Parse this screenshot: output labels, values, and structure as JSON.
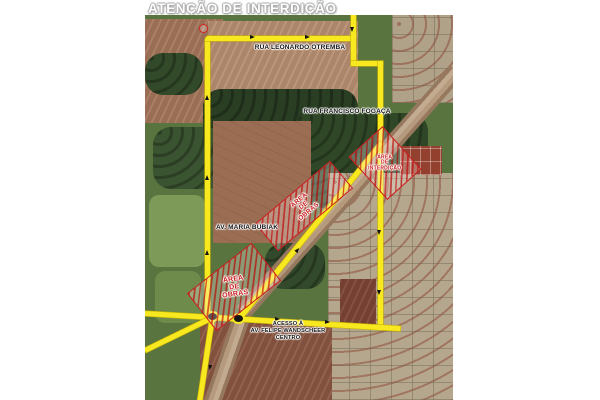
{
  "title": "ATENÇÃO DE INTERDIÇÃO",
  "map": {
    "streets": {
      "rua_leonardo_otremba": "RUA LEONARDO OTREMBA",
      "rua_francisco_fogaca": "RUA FRANCISCO FOGAÇA",
      "av_maria_bubiak": "AV. MARIA BUBIAK",
      "acesso": {
        "line1": "ACESSO À",
        "line2": "AV. FELIPE WANDSCHEER",
        "line3": "CENTRO"
      }
    },
    "zones": {
      "obras_central": {
        "line1": "ÁREA",
        "line2": "DE",
        "line3": "OBRAS"
      },
      "obras_left": {
        "line1": "ÁREA",
        "line2": "DE",
        "line3": "OBRAS"
      },
      "interdicao": {
        "line1": "ÁREA",
        "line2": "DE",
        "line3": "INTERDIÇÃO"
      }
    },
    "icons": {
      "prohibition_sign": "no-entry",
      "roundabout_count": 2
    },
    "colors": {
      "route_yellow": "#f8e81f",
      "alert_red": "#c81c1c",
      "title_white": "#fefefe"
    }
  }
}
